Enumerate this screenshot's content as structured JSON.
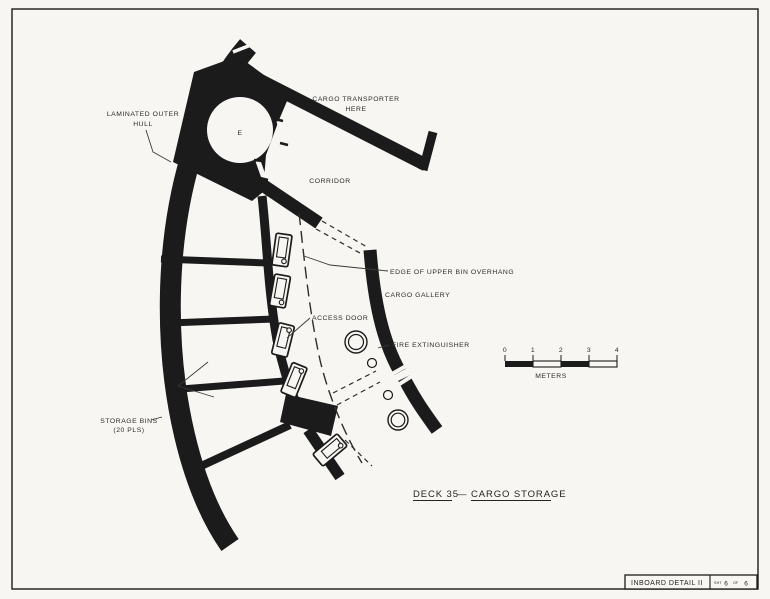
{
  "colors": {
    "ink": "#1b1b1b",
    "paper": "#f7f6f3"
  },
  "labels": {
    "laminated_outer_hull_1": "LAMINATED OUTER",
    "laminated_outer_hull_2": "HULL",
    "cargo_transporter_1": "CARGO TRANSPORTER",
    "cargo_transporter_2": "HERE",
    "corridor": "CORRIDOR",
    "edge_of_upper_bin_overhang": "EDGE OF UPPER BIN OVERHANG",
    "cargo_gallery": "CARGO GALLERY",
    "access_door": "ACCESS DOOR",
    "fire_extinguisher": "FIRE EXTINGUISHER",
    "storage_bins_1": "STORAGE BINS",
    "storage_bins_2": "(20 PLS)",
    "transporter_pad": "E"
  },
  "scale_bar": {
    "ticks": [
      "0",
      "1",
      "2",
      "3",
      "4"
    ],
    "unit": "METERS"
  },
  "drawing_title": {
    "deck": "DECK 35",
    "separator": "—",
    "subject": "CARGO STORAGE"
  },
  "title_block": {
    "name": "INBOARD DETAIL II",
    "sheet_prefix": "SHT",
    "sheet_number": "6",
    "sheet_of": "OF",
    "sheet_total": "6"
  }
}
